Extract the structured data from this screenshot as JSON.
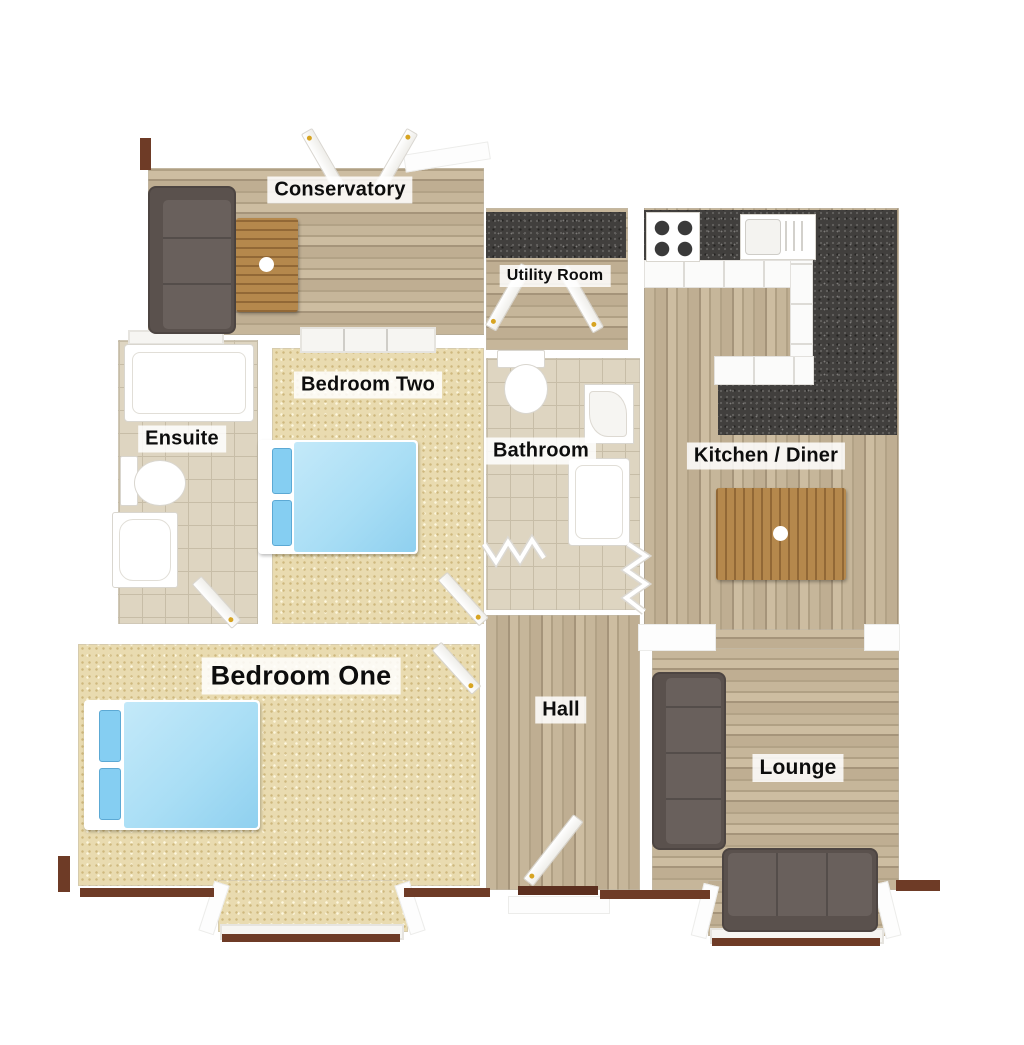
{
  "image_type": "3d-floorplan-render",
  "rooms": [
    {
      "id": "conservatory",
      "label": "Conservatory"
    },
    {
      "id": "utility-room",
      "label": "Utility Room"
    },
    {
      "id": "bedroom-two",
      "label": "Bedroom Two"
    },
    {
      "id": "ensuite",
      "label": "Ensuite"
    },
    {
      "id": "bathroom",
      "label": "Bathroom"
    },
    {
      "id": "kitchen-diner",
      "label": "Kitchen / Diner"
    },
    {
      "id": "bedroom-one",
      "label": "Bedroom One"
    },
    {
      "id": "hall",
      "label": "Hall"
    },
    {
      "id": "lounge",
      "label": "Lounge"
    }
  ],
  "furniture": [
    "corner-sofa-conservatory",
    "coffee-table",
    "dining-table",
    "hob",
    "kitchen-sink",
    "granite-worktops",
    "double-bed-bedroom-two",
    "double-bed-bedroom-one",
    "toilet-bathroom",
    "corner-basin-bathroom",
    "bath-bathroom",
    "bath-ensuite",
    "toilet-ensuite",
    "shower-ensuite",
    "lounge-sofa",
    "lounge-bay-sofa"
  ],
  "palette": {
    "wood": "#bcab8f",
    "carpet": "#e9dbb0",
    "tile": "#ded5c1",
    "granite": "#413f3d",
    "sofa": "#5a514d",
    "bed": "#a9def5",
    "pillow": "#85cef2",
    "tableWood": "#b5884c",
    "wallWhite": "#ffffff",
    "baseBrown": "#6e3b26",
    "handleGold": "#d7a422",
    "labelBg": "rgba(255,255,255,0.85)",
    "labelColor": "#0d0d0d"
  }
}
